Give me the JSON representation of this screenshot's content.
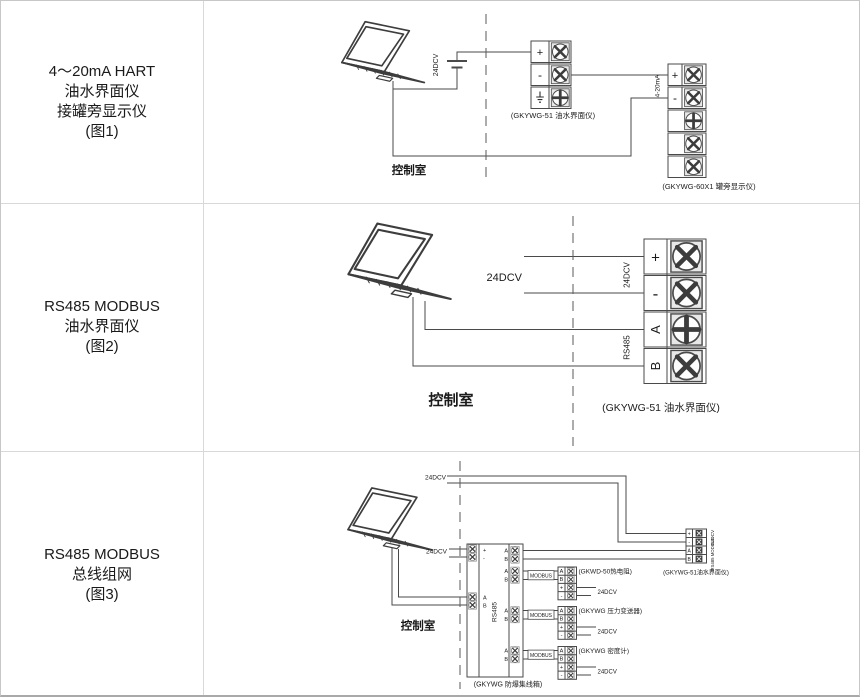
{
  "fig1": {
    "sidebar": [
      "4～20mA HART",
      "油水界面仪",
      "接罐旁显示仪",
      "(图1)"
    ],
    "battery_voltage": "24DCV",
    "loop_signal": "4-20mA",
    "control_room": "控制室",
    "meter_block": {
      "plus": "+",
      "minus": "-",
      "ground_icon": "earth-ground",
      "caption": "(GKYWG-51 油水界面仪)"
    },
    "display_block": {
      "plus": "+",
      "minus": "-",
      "caption": "(GKYWG-60X1 罐旁显示仪)"
    }
  },
  "fig2": {
    "sidebar": [
      "RS485 MODBUS",
      "油水界面仪",
      "(图2)"
    ],
    "power_label": "24DCV",
    "power_vertical": "24DCV",
    "bus_vertical": "RS485",
    "control_room": "控制室",
    "meter_block": {
      "terminals": [
        "+",
        "-",
        "A",
        "B"
      ],
      "caption": "(GKYWG-51 油水界面仪)"
    }
  },
  "fig3": {
    "sidebar": [
      "RS485 MODBUS",
      "总线组网",
      "(图3)"
    ],
    "power_top": "24DCV",
    "power_left": "24DCV",
    "control_room": "控制室",
    "hub": {
      "left_terminals": [
        "+",
        "-",
        "A",
        "B"
      ],
      "port_a": "A",
      "port_b": "B",
      "bus_vertical": "RS485",
      "caption": "(GKYWG 防爆集线箱)"
    },
    "modbus_label": "MODBUS",
    "device_terminals": [
      "A",
      "B",
      "+",
      "-"
    ],
    "devices": [
      {
        "caption": "(GKWD-50热电阻)",
        "power": "24DCV"
      },
      {
        "caption": "(GKYWG 压力变送器)",
        "power": "24DCV"
      },
      {
        "caption": "(GKYWG 密度计)",
        "power": "24DCV"
      }
    ],
    "right_block": {
      "terminals": [
        "+",
        "-",
        "A",
        "B"
      ],
      "power_vertical": "24DCV",
      "bus_vertical": "RS485 MODBUS",
      "caption": "(GKYWG-51油水界面仪)"
    }
  }
}
